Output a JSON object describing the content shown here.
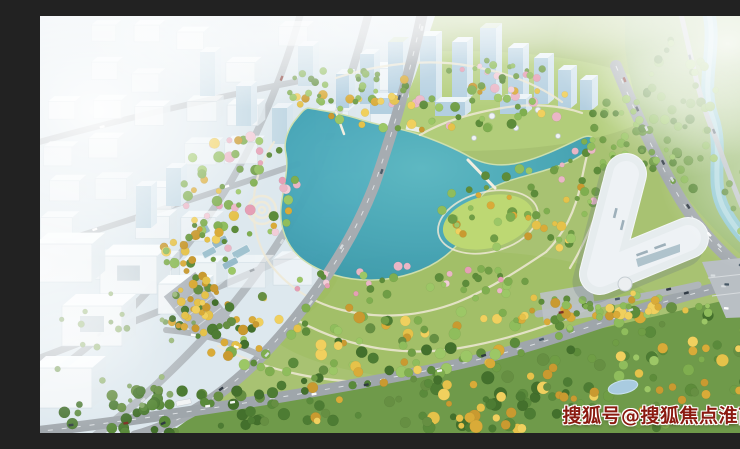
{
  "scene": {
    "type": "aerial-architectural-rendering",
    "subject": "lakeside park masterplan with office towers, curved white exhibition building, river corridor and roads",
    "watermark": {
      "text": "搜狐号@搜狐焦点淮南站",
      "color": "#8a1a10",
      "outline_color": "#ffffff"
    },
    "features": [
      "hazy-city-district-left",
      "office-tower-cluster-top",
      "central-teal-lake",
      "lawn-island",
      "spiral-garden",
      "wetland-cells",
      "curved-white-building",
      "river-corridor-right",
      "arterial-roads-with-cars",
      "dense-forest-band-bottom",
      "cherry-blossom-paths",
      "autumn-yellow-trees",
      "fog-overlay"
    ],
    "palette": {
      "haze_white": "#f2f7fa",
      "city_blue": "#b7d0e0",
      "lake_teal": "#44a7b8",
      "river_teal": "#8fc8d2",
      "park_green": "#a8c272",
      "forest_green": "#4d7c33",
      "autumn_yellow": "#e5c24a",
      "blossom_pink": "#eab6c6",
      "road_gray": "#a2a8ad",
      "building_white": "#f4f7f8"
    }
  }
}
